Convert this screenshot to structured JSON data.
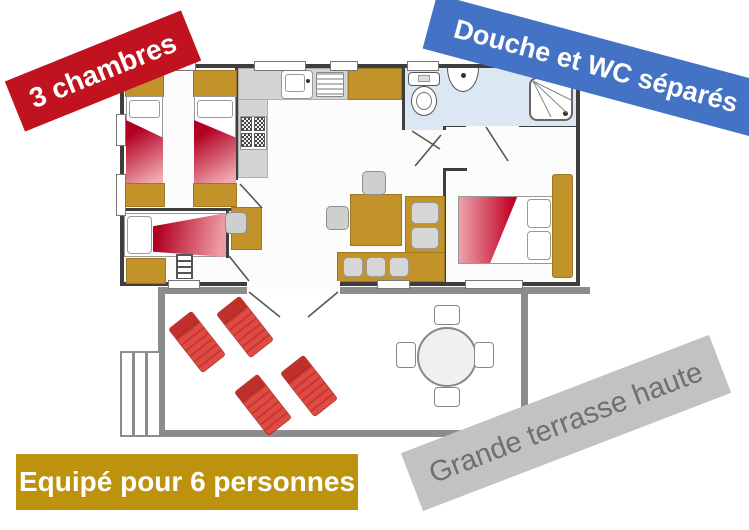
{
  "banners": {
    "bedrooms": {
      "label": "3 chambres",
      "bg": "#c1121f",
      "fg": "#ffffff"
    },
    "bathroom": {
      "label": "Douche et WC séparés",
      "bg": "#4472c4",
      "fg": "#ffffff"
    },
    "capacity": {
      "label": "Equipé pour 6 personnes",
      "bg": "#bd920f",
      "fg": "#ffffff"
    },
    "terrace": {
      "label": "Grande terrasse haute",
      "bg": "#c2c2c2",
      "fg": "#6f6f6f"
    }
  },
  "colors": {
    "wall": "#3e3e3e",
    "furniture_wood": "#c3932b",
    "bed_blanket_red": "#b10021",
    "kitchen_counter": "#d4d4d4",
    "bathroom_floor": "#dbe8f4",
    "terrace_border": "#8c8c8c",
    "sun_lounger_red": "#e04a42",
    "seat_gray": "#cfcfcf"
  }
}
